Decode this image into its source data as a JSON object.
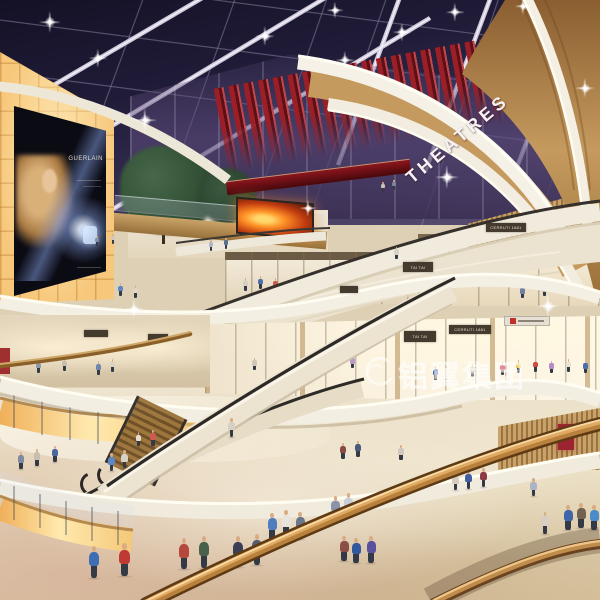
{
  "meta": {
    "description": "Photorealistic architectural rendering of a multi-level shopping mall atrium at night: dark skylight-grid ceiling with spotlights, red-slatted cinema marquee, glowing amber light-box wall with perfume billboard, curved cove-lit white balcony fascias, crisscrossing escalators, storefronts and crowds of shoppers"
  },
  "signage": {
    "theatre_label": "THEATRES",
    "billboard_brand": "GUERLAIN",
    "watermark_text": "铝翼集团",
    "plates": [
      {
        "t": "TAI TAI",
        "x": 403,
        "y": 262,
        "w": 30,
        "h": 10,
        "s": "dark"
      },
      {
        "t": "CERRUTI 1881",
        "x": 486,
        "y": 223,
        "w": 40,
        "h": 9,
        "s": "dark"
      },
      {
        "t": "TAI TAI",
        "x": 404,
        "y": 331,
        "w": 32,
        "h": 11,
        "s": "dark"
      },
      {
        "t": "CERRUTI 1881",
        "x": 449,
        "y": 325,
        "w": 42,
        "h": 9,
        "s": "dark"
      },
      {
        "t": "",
        "x": 84,
        "y": 330,
        "w": 24,
        "h": 7,
        "s": "dark"
      },
      {
        "t": "",
        "x": 148,
        "y": 334,
        "w": 20,
        "h": 7,
        "s": "dark"
      },
      {
        "t": "",
        "x": 340,
        "y": 286,
        "w": 18,
        "h": 7,
        "s": "dark"
      },
      {
        "t": "",
        "x": 504,
        "y": 316,
        "w": 46,
        "h": 10,
        "s": "light",
        "logo": true
      }
    ]
  },
  "palette": {
    "sky_dark": "#141126",
    "sky_light": "#5f5478",
    "beam": "#cfc8da",
    "theatre_red": "#9c1f27",
    "amber_wall": "#f7c87c",
    "amber_glow": "#ffe9ae",
    "wood": "#c59a5e",
    "wood_dark": "#8a5e30",
    "fascia_white": "#f5f1e6",
    "cream_parapet": "#ece3d0",
    "floor_beige": "#e6d8bc",
    "handrail_black": "#2d2926",
    "skin": "#d9ab84"
  },
  "people": [
    [
      95,
      236,
      10,
      "#8090aa",
      "far"
    ],
    [
      111,
      234,
      10,
      "#d0c9bb",
      "far"
    ],
    [
      209,
      240,
      11,
      "#b0b8c6",
      "far"
    ],
    [
      224,
      238,
      11,
      "#5c6e8e",
      "far"
    ],
    [
      381,
      182,
      10,
      "#c8c2b4",
      "far"
    ],
    [
      392,
      180,
      10,
      "#7888a0",
      "far"
    ],
    [
      243,
      278,
      13,
      "#d6d0c4",
      "far"
    ],
    [
      258,
      276,
      13,
      "#4e6fa8",
      "far"
    ],
    [
      273,
      278,
      13,
      "#cf5a50",
      "far"
    ],
    [
      304,
      280,
      13,
      "#9aa4b4",
      "far"
    ],
    [
      345,
      280,
      12,
      "#d8d2c6",
      "far"
    ],
    [
      363,
      278,
      12,
      "#6a7a96",
      "far"
    ],
    [
      118,
      283,
      13,
      "#5d87c4",
      "far"
    ],
    [
      133,
      285,
      13,
      "#ddd6c9",
      "far"
    ],
    [
      520,
      286,
      12,
      "#6f80a0",
      "far"
    ],
    [
      542,
      284,
      12,
      "#c8beae",
      "far"
    ],
    [
      394,
      247,
      12,
      "#d8d2c6",
      "deck"
    ],
    [
      500,
      362,
      13,
      "#e87f9a",
      "mid"
    ],
    [
      516,
      360,
      13,
      "#e8c23c",
      "mid"
    ],
    [
      533,
      359,
      13,
      "#d0493f",
      "mid"
    ],
    [
      549,
      361,
      12,
      "#b48cc8",
      "mid"
    ],
    [
      566,
      359,
      13,
      "#e8e2d4",
      "mid"
    ],
    [
      583,
      361,
      12,
      "#4a6fae",
      "mid"
    ],
    [
      433,
      366,
      14,
      "#3f5fa0",
      "mid"
    ],
    [
      470,
      364,
      13,
      "#e0d8ca",
      "mid"
    ],
    [
      310,
      356,
      12,
      "#d8d2c4",
      "mid"
    ],
    [
      329,
      354,
      12,
      "#3c3c44",
      "mid"
    ],
    [
      350,
      356,
      12,
      "#b89ac8",
      "mid"
    ],
    [
      252,
      358,
      12,
      "#cfc8ba",
      "mid"
    ],
    [
      36,
      360,
      13,
      "#8c9aae",
      "mid"
    ],
    [
      62,
      358,
      13,
      "#c8beb0",
      "mid"
    ],
    [
      96,
      361,
      14,
      "#6d86ae",
      "mid"
    ],
    [
      110,
      359,
      13,
      "#d9d2c5",
      "mid"
    ],
    [
      340,
      443,
      16,
      "#8a4a42",
      "mid"
    ],
    [
      355,
      441,
      16,
      "#4a5a7c",
      "mid"
    ],
    [
      398,
      445,
      15,
      "#d0c8ba",
      "mid"
    ],
    [
      88,
      546,
      32,
      "#3e6fb4",
      "near"
    ],
    [
      118,
      543,
      33,
      "#c03a34",
      "near"
    ],
    [
      178,
      538,
      31,
      "#b5483c",
      "near"
    ],
    [
      198,
      536,
      32,
      "#49604a",
      "near"
    ],
    [
      232,
      536,
      31,
      "#3a3f55",
      "near"
    ],
    [
      251,
      534,
      31,
      "#565d70",
      "near"
    ],
    [
      267,
      513,
      27,
      "#4f7dbf",
      "near"
    ],
    [
      281,
      510,
      27,
      "#e8e4da",
      "near"
    ],
    [
      295,
      512,
      27,
      "#6a7788",
      "near"
    ],
    [
      331,
      496,
      23,
      "#8a93a8",
      "near"
    ],
    [
      344,
      493,
      23,
      "#c8cdd8",
      "near"
    ],
    [
      351,
      538,
      25,
      "#31589e",
      "near"
    ],
    [
      366,
      536,
      27,
      "#5b4f9e",
      "near"
    ],
    [
      339,
      536,
      25,
      "#8c4f46",
      "near"
    ],
    [
      541,
      512,
      22,
      "#d8cfc2",
      "near"
    ],
    [
      563,
      505,
      25,
      "#3e66a8",
      "near"
    ],
    [
      576,
      503,
      25,
      "#72624f",
      "near"
    ],
    [
      589,
      505,
      25,
      "#4b8bc8",
      "near"
    ],
    [
      465,
      470,
      19,
      "#415f9e",
      "near"
    ],
    [
      480,
      468,
      19,
      "#8c3a44",
      "near"
    ],
    [
      452,
      472,
      18,
      "#d4cdc0",
      "near"
    ],
    [
      530,
      478,
      18,
      "#aab4c4",
      "near"
    ],
    [
      228,
      418,
      19,
      "#d6cfc4",
      "near"
    ],
    [
      18,
      452,
      17,
      "#7d8aa0",
      "near"
    ],
    [
      34,
      449,
      17,
      "#c8beae",
      "near"
    ],
    [
      52,
      446,
      16,
      "#4a6a9e",
      "near"
    ],
    [
      108,
      453,
      18,
      "#5d87c4",
      "near"
    ],
    [
      121,
      450,
      18,
      "#d8d2c6",
      "near"
    ],
    [
      150,
      430,
      16,
      "#cf5a50",
      "near"
    ],
    [
      136,
      432,
      14,
      "#e4ddd0",
      "near"
    ]
  ],
  "sparkles": [
    [
      50,
      22,
      12
    ],
    [
      98,
      58,
      10
    ],
    [
      145,
      120,
      13
    ],
    [
      265,
      36,
      11
    ],
    [
      345,
      60,
      10
    ],
    [
      402,
      32,
      10
    ],
    [
      455,
      12,
      10
    ],
    [
      523,
      6,
      9
    ],
    [
      585,
      88,
      11
    ],
    [
      335,
      10,
      9
    ],
    [
      447,
      177,
      13
    ],
    [
      548,
      306,
      13
    ],
    [
      134,
      309,
      11
    ],
    [
      308,
      208,
      9
    ]
  ]
}
